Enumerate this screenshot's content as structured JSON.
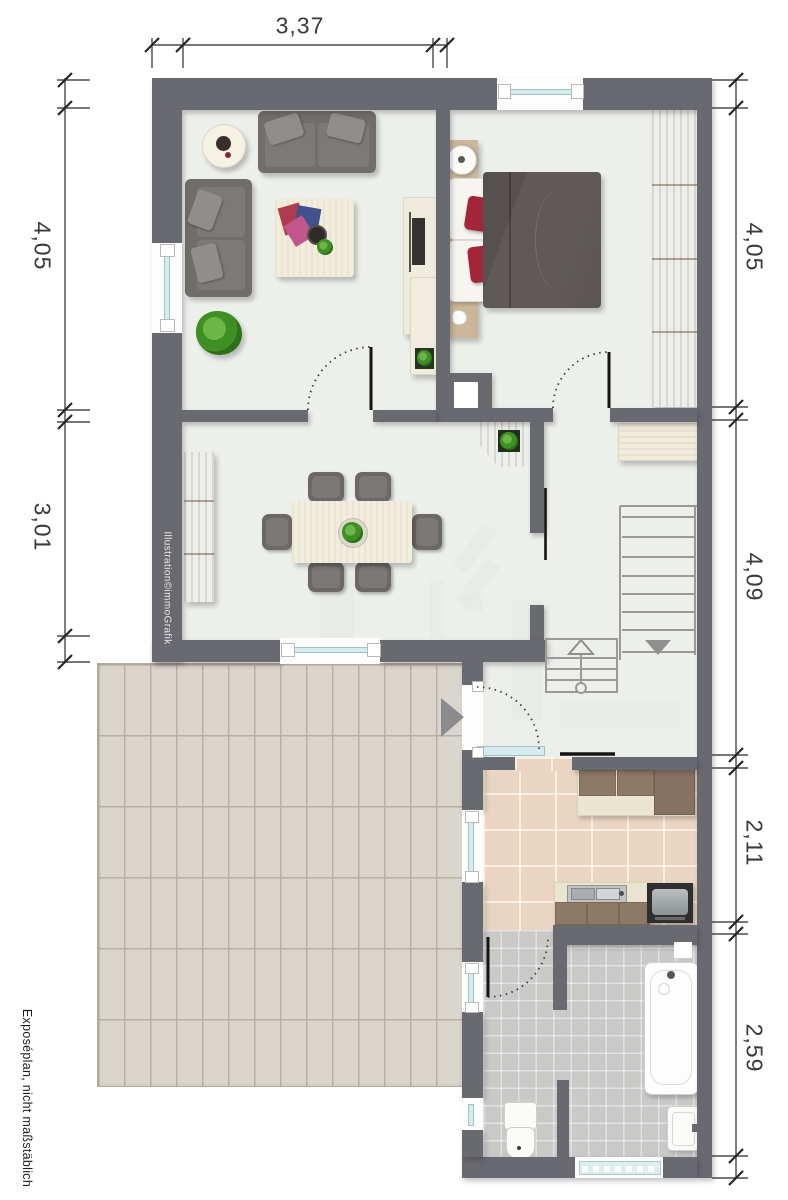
{
  "document": {
    "type": "floor-plan",
    "credit": "Illustration©immoGrafik",
    "disclaimer": "Exposéplan, nicht maßstäblich"
  },
  "dimensions": {
    "top_width": "3,37",
    "left_upper": "4,05",
    "left_lower": "3,01",
    "right_bedroom": "4,05",
    "right_hall": "4,09",
    "right_kitchen": "2,11",
    "right_bath": "2,59"
  },
  "colors": {
    "wall": "#696970",
    "floor": "#edefeb",
    "terrace_paving": "#dbd6cd",
    "kitchen_tile": "#e9d5c1",
    "bath_tile": "#c9c9c8",
    "wood": "#a68a72",
    "sofa": "#716d6a",
    "accent_red": "#a32638",
    "window_glass": "#d6ebee",
    "dimension_text": "#3a3a3a"
  }
}
